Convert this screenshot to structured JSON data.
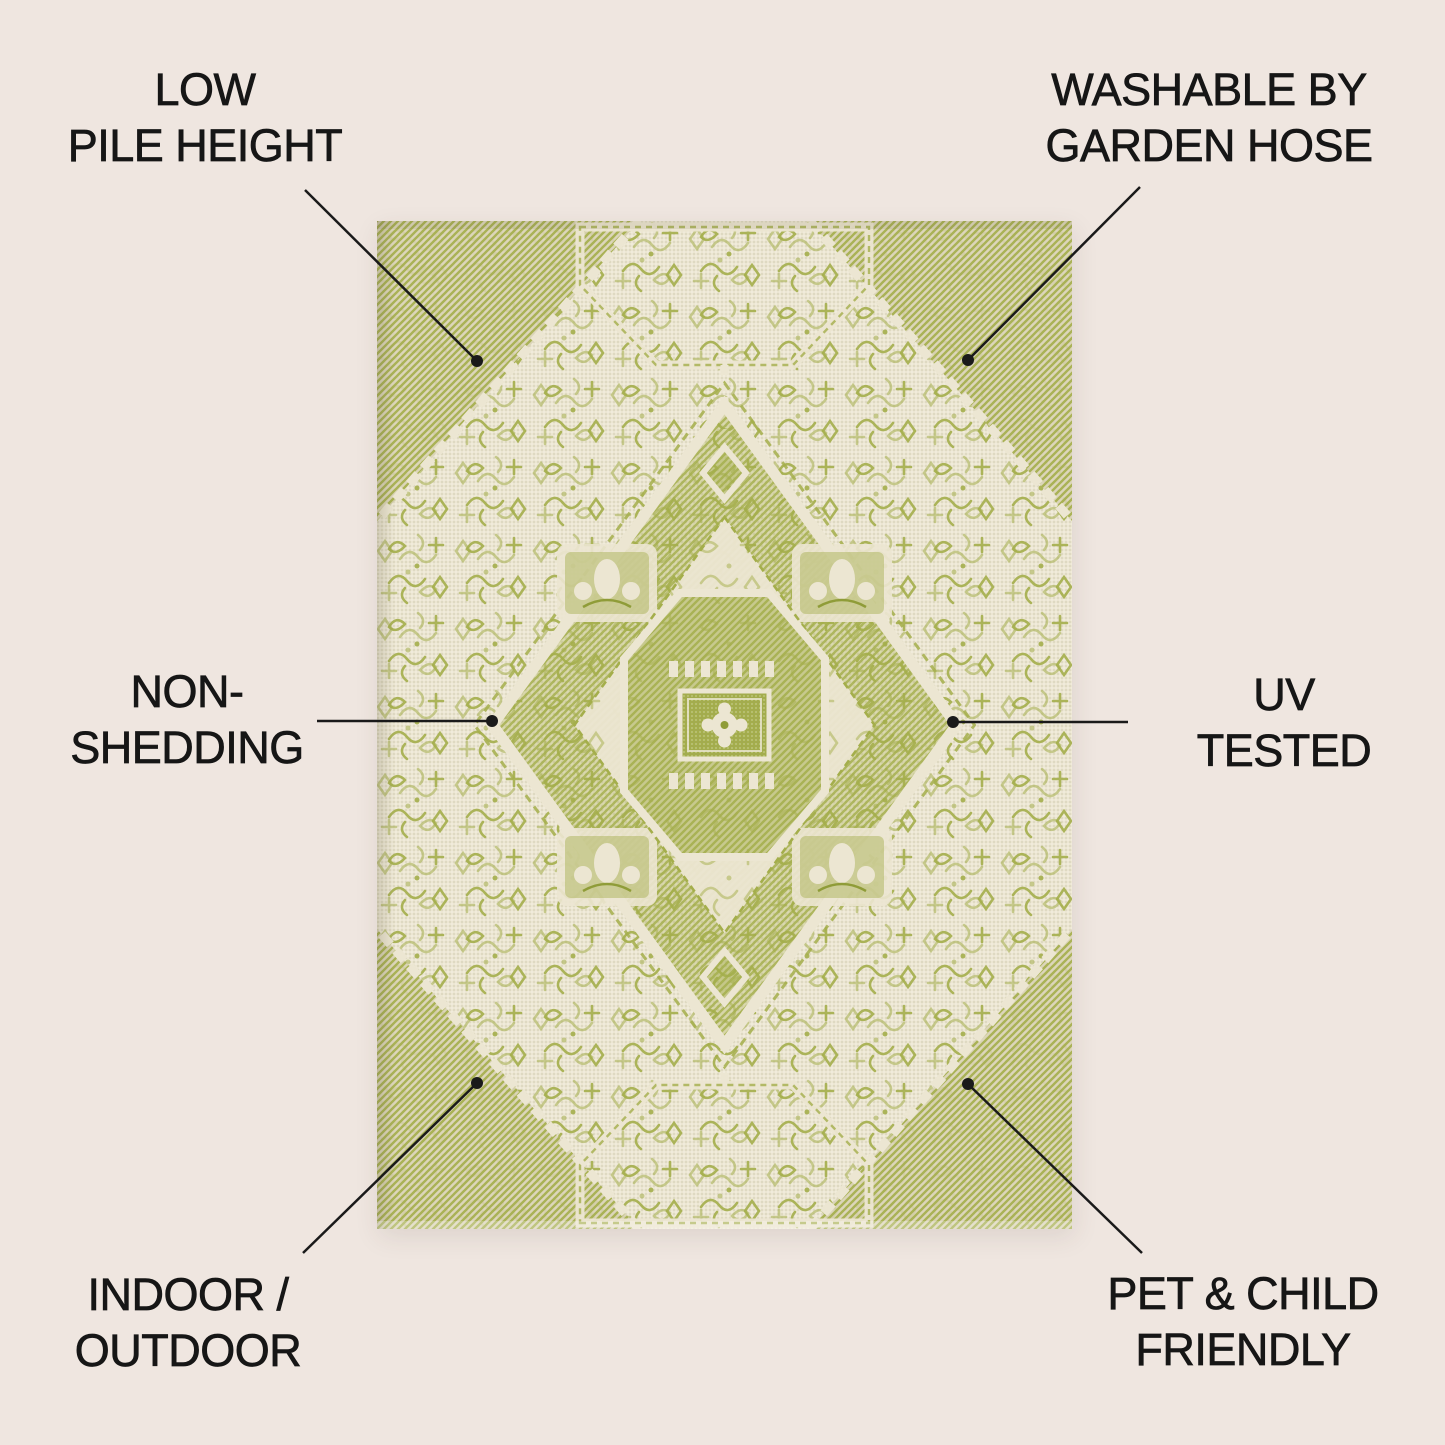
{
  "colors": {
    "bg": "#efe6e0",
    "text": "#161616",
    "line": "#1a1a1a",
    "rug_cream": "#ece6d2",
    "rug_green": "#a4ae4b",
    "rug_green_deep": "#8f9c38",
    "rug_beige": "#d9d2b6"
  },
  "features": [
    {
      "id": "low-pile-height",
      "label_lines": [
        "LOW",
        "PILE HEIGHT"
      ]
    },
    {
      "id": "washable-by-garden-hose",
      "label_lines": [
        "WASHABLE BY",
        "GARDEN HOSE"
      ]
    },
    {
      "id": "non-shedding",
      "label_lines": [
        "NON-",
        "SHEDDING"
      ]
    },
    {
      "id": "uv-tested",
      "label_lines": [
        "UV",
        "TESTED"
      ]
    },
    {
      "id": "indoor-outdoor",
      "label_lines": [
        "INDOOR /",
        "OUTDOOR"
      ]
    },
    {
      "id": "pet-child-friendly",
      "label_lines": [
        "PET & CHILD",
        "FRIENDLY"
      ]
    }
  ]
}
